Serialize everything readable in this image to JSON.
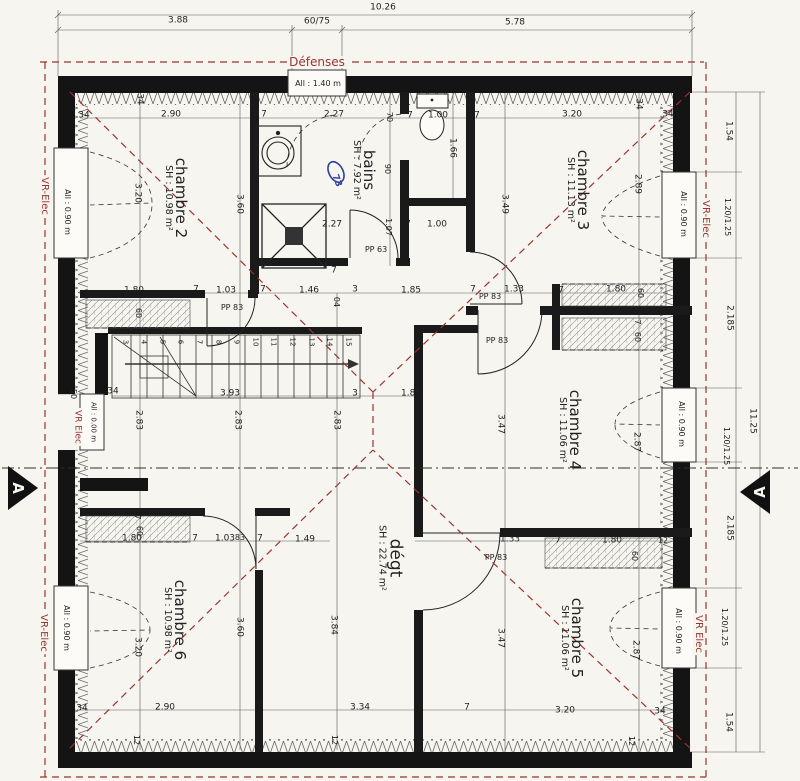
{
  "plan": {
    "colors": {
      "paper": "#f6f5f0",
      "ink": "#1c1c1c",
      "red": "#9b3330",
      "blue": "#2b3f9e"
    },
    "section_left": "A",
    "section_right": "A",
    "rooms": [
      {
        "name": "chambre 2",
        "sh": "SH : 10.98 m²",
        "x": 176,
        "y": 198,
        "ns": 15
      },
      {
        "name": "chambre 3",
        "sh": "SH : 11.13 m²",
        "x": 578,
        "y": 190,
        "ns": 15
      },
      {
        "name": "chambre 4",
        "sh": "SH : 11.06 m²",
        "x": 570,
        "y": 430,
        "ns": 15
      },
      {
        "name": "chambre 5",
        "sh": "SH : 11.06 m²",
        "x": 572,
        "y": 638,
        "ns": 15
      },
      {
        "name": "chambre 6",
        "sh": "SH : 10.98 m²",
        "x": 175,
        "y": 620,
        "ns": 15
      },
      {
        "name": "bains",
        "sh": "SH : 7.92 m²",
        "x": 364,
        "y": 170,
        "ns": 15
      },
      {
        "name": "dégt",
        "sh": "SH : 22.74 m²",
        "x": 390,
        "y": 558,
        "ns": 17
      }
    ],
    "stairs": {
      "numbers": [
        "3",
        "4",
        "5",
        "6",
        "7",
        "8",
        "9",
        "10",
        "11",
        "12",
        "13",
        "14",
        "15"
      ],
      "x0": 124.5,
      "dx": 18.6,
      "y": 342
    },
    "labels": [
      {
        "t": "10.26",
        "x": 383,
        "y": 8
      },
      {
        "t": "3.88",
        "x": 178,
        "y": 21
      },
      {
        "t": "60/75",
        "x": 317,
        "y": 22
      },
      {
        "t": "5.78",
        "x": 515,
        "y": 23
      },
      {
        "t": "Défenses",
        "x": 317,
        "y": 62,
        "c": "red",
        "s": 12
      },
      {
        "t": "All : 1.40 m",
        "x": 318,
        "y": 84,
        "s": 8
      },
      {
        "t": "34",
        "x": 84,
        "y": 116
      },
      {
        "t": "34",
        "x": 139,
        "y": 99,
        "r": 90
      },
      {
        "t": "2.90",
        "x": 171,
        "y": 115
      },
      {
        "t": "7",
        "x": 264,
        "y": 115
      },
      {
        "t": "2.27",
        "x": 334,
        "y": 115
      },
      {
        "t": "70",
        "x": 389,
        "y": 117,
        "r": 90,
        "s": 8
      },
      {
        "t": "7",
        "x": 410,
        "y": 116
      },
      {
        "t": "1.00",
        "x": 438,
        "y": 116
      },
      {
        "t": "7",
        "x": 477,
        "y": 116
      },
      {
        "t": "3.20",
        "x": 572,
        "y": 115
      },
      {
        "t": "34",
        "x": 638,
        "y": 104,
        "r": 90
      },
      {
        "t": "34",
        "x": 668,
        "y": 115
      },
      {
        "t": "3.20",
        "x": 137,
        "y": 193,
        "r": 90
      },
      {
        "t": "3.60",
        "x": 239,
        "y": 204,
        "r": 90
      },
      {
        "t": "90",
        "x": 387,
        "y": 169,
        "r": 90,
        "s": 8
      },
      {
        "t": "1.66",
        "x": 452,
        "y": 148,
        "r": 90
      },
      {
        "t": "3.49",
        "x": 504,
        "y": 204,
        "r": 90
      },
      {
        "t": "2.89",
        "x": 637,
        "y": 184,
        "r": 90
      },
      {
        "t": "73",
        "x": 336,
        "y": 181,
        "r": 70,
        "c": "blue",
        "s": 9
      },
      {
        "t": "2.27",
        "x": 332,
        "y": 225
      },
      {
        "t": "7",
        "x": 408,
        "y": 225
      },
      {
        "t": "1.00",
        "x": 437,
        "y": 225
      },
      {
        "t": "1.07",
        "x": 388,
        "y": 227,
        "r": 90,
        "s": 8
      },
      {
        "t": "PP 63",
        "x": 376,
        "y": 250,
        "s": 8
      },
      {
        "t": "7",
        "x": 334,
        "y": 271
      },
      {
        "t": "1.80",
        "x": 134,
        "y": 291
      },
      {
        "t": "7",
        "x": 196,
        "y": 290
      },
      {
        "t": "1.03",
        "x": 226,
        "y": 291
      },
      {
        "t": "7",
        "x": 263,
        "y": 290
      },
      {
        "t": "1.46",
        "x": 309,
        "y": 291
      },
      {
        "t": "3",
        "x": 355,
        "y": 290
      },
      {
        "t": "04",
        "x": 336,
        "y": 302,
        "r": 90,
        "s": 8
      },
      {
        "t": "1.85",
        "x": 411,
        "y": 291
      },
      {
        "t": "7",
        "x": 473,
        "y": 290
      },
      {
        "t": "1.33",
        "x": 514,
        "y": 290
      },
      {
        "t": "7",
        "x": 561,
        "y": 291
      },
      {
        "t": "1.80",
        "x": 616,
        "y": 290
      },
      {
        "t": "60",
        "x": 640,
        "y": 293,
        "r": 90,
        "s": 8
      },
      {
        "t": "60",
        "x": 138,
        "y": 313,
        "r": 90,
        "s": 8
      },
      {
        "t": "7",
        "x": 637,
        "y": 322,
        "r": 90,
        "s": 8
      },
      {
        "t": "60",
        "x": 637,
        "y": 337,
        "r": 90,
        "s": 8
      },
      {
        "t": "PP 83",
        "x": 232,
        "y": 308,
        "s": 8
      },
      {
        "t": "PP 83",
        "x": 490,
        "y": 297,
        "s": 8
      },
      {
        "t": "PP 83",
        "x": 497,
        "y": 341,
        "s": 8
      },
      {
        "t": "3.93",
        "x": 230,
        "y": 394
      },
      {
        "t": "34",
        "x": 113,
        "y": 392
      },
      {
        "t": "50",
        "x": 73,
        "y": 394,
        "r": 90,
        "s": 8
      },
      {
        "t": "2.83",
        "x": 138,
        "y": 420,
        "r": 90
      },
      {
        "t": "2.83",
        "x": 237,
        "y": 420,
        "r": 90
      },
      {
        "t": "2.83",
        "x": 336,
        "y": 420,
        "r": 90
      },
      {
        "t": "1.85",
        "x": 411,
        "y": 394
      },
      {
        "t": "3",
        "x": 355,
        "y": 394
      },
      {
        "t": "3.47",
        "x": 500,
        "y": 424,
        "r": 90
      },
      {
        "t": "2.87",
        "x": 636,
        "y": 442,
        "r": 90
      },
      {
        "t": "All : 0.90 m",
        "x": 67,
        "y": 212,
        "r": 90,
        "s": 8
      },
      {
        "t": "All : 0.00 m",
        "x": 93,
        "y": 422,
        "r": 90,
        "s": 7
      },
      {
        "t": "All : 0.90 m",
        "x": 66,
        "y": 628,
        "r": 90,
        "s": 8
      },
      {
        "t": "VR-Elec",
        "x": 44,
        "y": 196,
        "r": 90,
        "c": "red",
        "s": 10
      },
      {
        "t": "VR Elec",
        "x": 77,
        "y": 427,
        "r": 90,
        "c": "red",
        "s": 9
      },
      {
        "t": "VR-Elec",
        "x": 43,
        "y": 633,
        "r": 90,
        "c": "red",
        "s": 10
      },
      {
        "t": "All : 0.90 m",
        "x": 683,
        "y": 214,
        "r": 90,
        "s": 8
      },
      {
        "t": "All : 0.90 m",
        "x": 681,
        "y": 424,
        "r": 90,
        "s": 8
      },
      {
        "t": "All : 0.90 m",
        "x": 678,
        "y": 631,
        "r": 90,
        "s": 8
      },
      {
        "t": "VR-Elec",
        "x": 705,
        "y": 219,
        "r": 90,
        "c": "red",
        "s": 10
      },
      {
        "t": "VR Elec",
        "x": 698,
        "y": 634,
        "r": 90,
        "c": "red",
        "s": 10
      },
      {
        "t": "1.54",
        "x": 728,
        "y": 131,
        "r": 90
      },
      {
        "t": "1.20/1.25",
        "x": 727,
        "y": 217,
        "r": 90,
        "s": 8
      },
      {
        "t": "2.185",
        "x": 729,
        "y": 318,
        "r": 90
      },
      {
        "t": "1.20/1.25",
        "x": 726,
        "y": 446,
        "r": 90,
        "s": 8
      },
      {
        "t": "11.25",
        "x": 752,
        "y": 421,
        "r": 90
      },
      {
        "t": "2.185",
        "x": 729,
        "y": 528,
        "r": 90
      },
      {
        "t": "1.20/1.25",
        "x": 724,
        "y": 627,
        "r": 90,
        "s": 8
      },
      {
        "t": "1.54",
        "x": 728,
        "y": 722,
        "r": 90
      },
      {
        "t": "7",
        "x": 137,
        "y": 517,
        "r": 90,
        "s": 8
      },
      {
        "t": "60",
        "x": 139,
        "y": 531,
        "r": 90,
        "s": 8
      },
      {
        "t": "1.80",
        "x": 132,
        "y": 539
      },
      {
        "t": "7",
        "x": 195,
        "y": 539
      },
      {
        "t": "1.03",
        "x": 225,
        "y": 539
      },
      {
        "t": "83",
        "x": 240,
        "y": 538,
        "s": 8
      },
      {
        "t": "7",
        "x": 260,
        "y": 539
      },
      {
        "t": "1.49",
        "x": 305,
        "y": 540
      },
      {
        "t": "1.33",
        "x": 510,
        "y": 540
      },
      {
        "t": "7",
        "x": 558,
        "y": 541
      },
      {
        "t": "1.80",
        "x": 612,
        "y": 541
      },
      {
        "t": "12",
        "x": 663,
        "y": 541,
        "s": 8
      },
      {
        "t": "60",
        "x": 634,
        "y": 556,
        "r": 90,
        "s": 8
      },
      {
        "t": "PP 83",
        "x": 496,
        "y": 558,
        "s": 8
      },
      {
        "t": "3.20",
        "x": 137,
        "y": 647,
        "r": 90
      },
      {
        "t": "3.60",
        "x": 239,
        "y": 627,
        "r": 90
      },
      {
        "t": "3.84",
        "x": 333,
        "y": 625,
        "r": 90
      },
      {
        "t": "3.47",
        "x": 500,
        "y": 638,
        "r": 90
      },
      {
        "t": "2.87",
        "x": 635,
        "y": 650,
        "r": 90
      },
      {
        "t": "34",
        "x": 82,
        "y": 709
      },
      {
        "t": "2.90",
        "x": 165,
        "y": 708
      },
      {
        "t": "7",
        "x": 260,
        "y": 707
      },
      {
        "t": "3.34",
        "x": 360,
        "y": 708
      },
      {
        "t": "7",
        "x": 467,
        "y": 708
      },
      {
        "t": "3.20",
        "x": 565,
        "y": 711
      },
      {
        "t": "34",
        "x": 660,
        "y": 712
      },
      {
        "t": "12",
        "x": 136,
        "y": 740,
        "r": 90,
        "s": 8
      },
      {
        "t": "12",
        "x": 334,
        "y": 740,
        "r": 90,
        "s": 8
      },
      {
        "t": "12",
        "x": 631,
        "y": 741,
        "r": 90,
        "s": 8
      }
    ]
  }
}
